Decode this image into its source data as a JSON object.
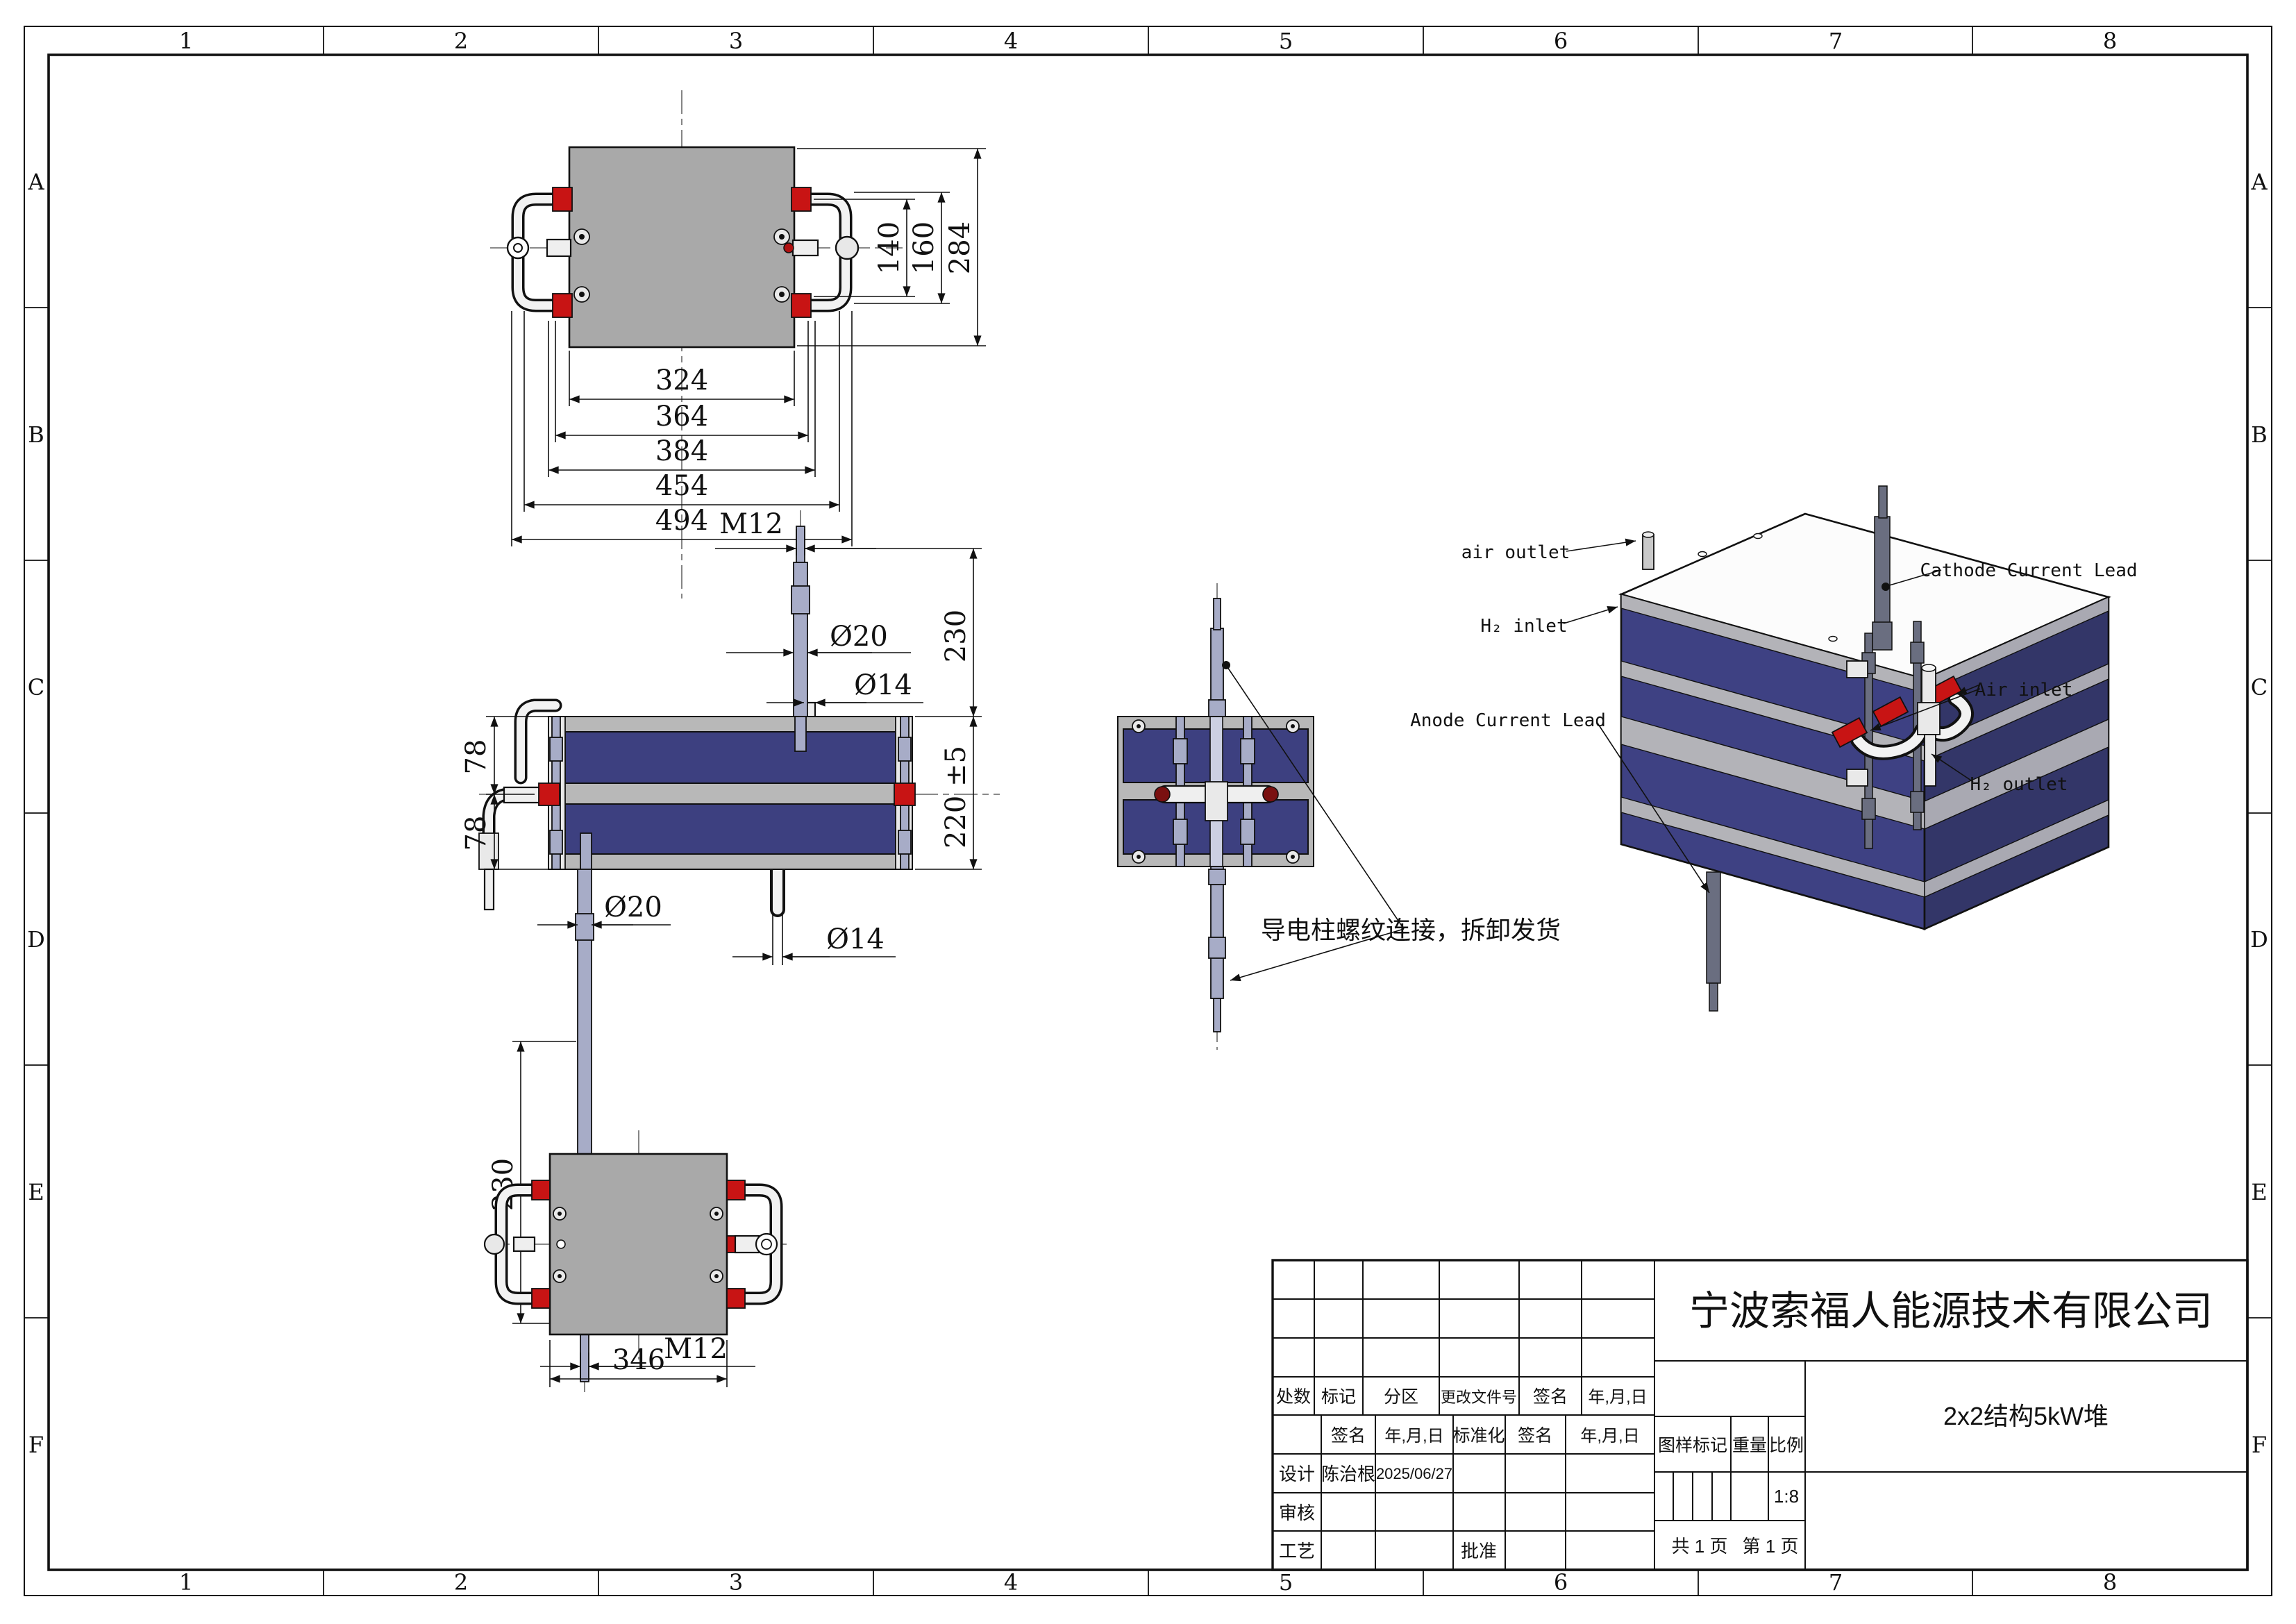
{
  "frame": {
    "columns": [
      "1",
      "2",
      "3",
      "4",
      "5",
      "6",
      "7",
      "8"
    ],
    "rows": [
      "A",
      "B",
      "C",
      "D",
      "E",
      "F"
    ]
  },
  "views": {
    "top": {
      "dim_324": "324",
      "dim_364": "364",
      "dim_384": "384",
      "dim_454": "454",
      "dim_494": "494",
      "dim_140": "140",
      "dim_160": "160",
      "dim_284": "284"
    },
    "front": {
      "dim_m12_top": "M12",
      "dim_phi20_top": "Ø20",
      "dim_230_top": "230",
      "dim_phi14_top": "Ø14",
      "dim_78_upper": "78",
      "dim_78_lower": "78",
      "dim_220": "220 ±5",
      "dim_phi14_bottom": "Ø14",
      "dim_phi20_bottom": "Ø20",
      "dim_230_bottom": "230",
      "dim_m12_bottom": "M12"
    },
    "side": {
      "note": "导电柱螺纹连接，拆卸发货"
    },
    "iso": {
      "label_air_outlet": "air outlet",
      "label_h2_inlet": "H₂ inlet",
      "label_anode": "Anode Current Lead",
      "label_cathode": "Cathode Current Lead",
      "label_air_inlet": "Air inlet",
      "label_h2_outlet": "H₂ outlet"
    },
    "bottom": {
      "dim_346": "346"
    }
  },
  "title_block": {
    "company": "宁波索福人能源技术有限公司",
    "drawing_title": "2x2结构5kW堆",
    "rev_header": {
      "qty": "处数",
      "mark": "标记",
      "zone": "分区",
      "doc_no": "更改文件号"
    },
    "sign": "签名",
    "date_fmt": "年,月,日",
    "std": "标准化",
    "row_design": "设计",
    "row_check": "审核",
    "row_process": "工艺",
    "row_approve": "批准",
    "designer": "陈治根",
    "design_date": "2025/06/27",
    "mark_label": "图样标记",
    "weight_label": "重量",
    "scale_label": "比例",
    "scale_value": "1:8",
    "pages_total": "共 1 页",
    "page_current": "第 1 页"
  }
}
